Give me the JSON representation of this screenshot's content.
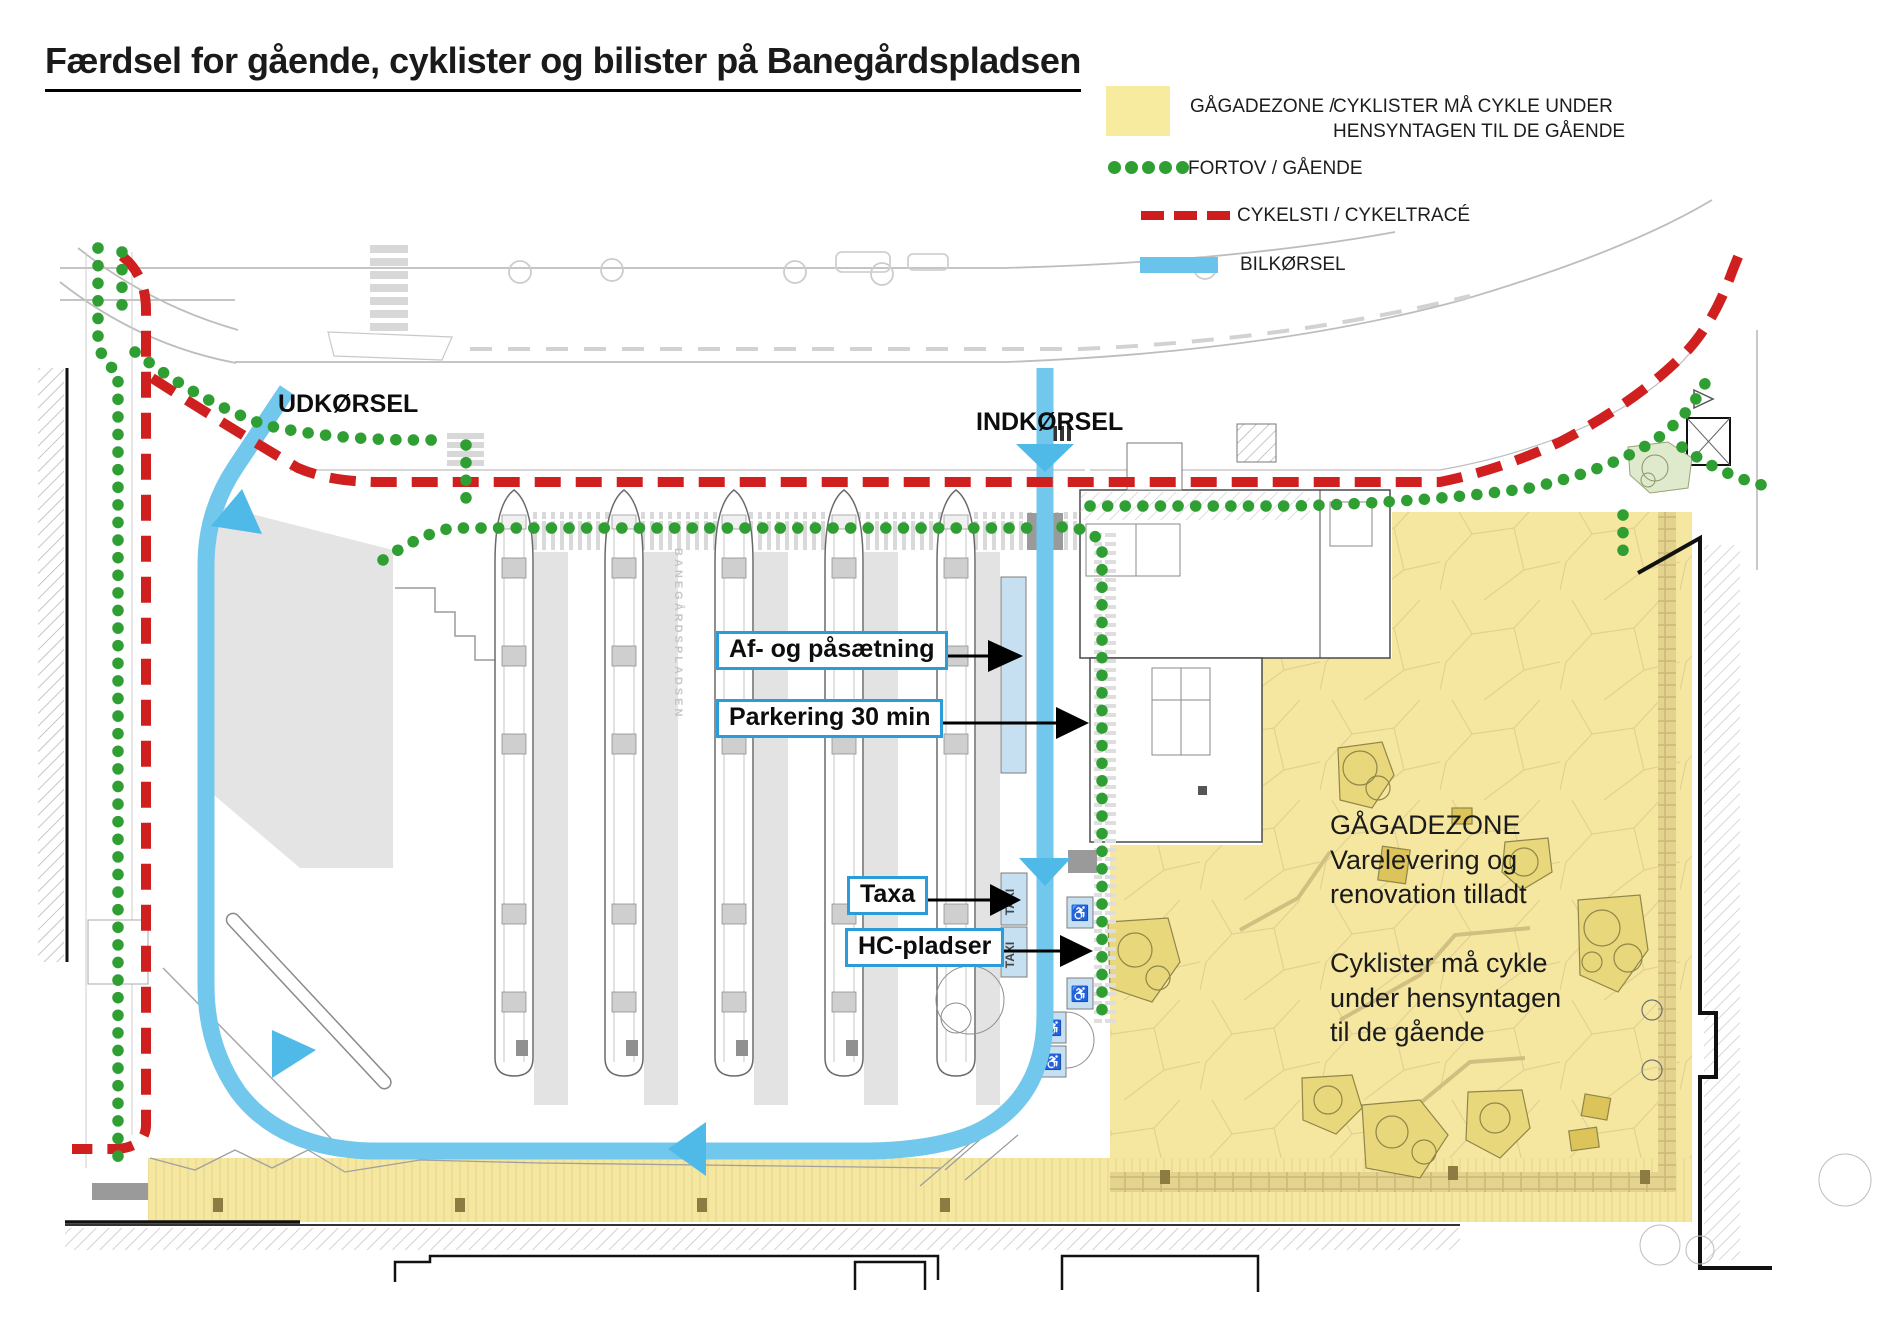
{
  "title": "Færdsel for gående, cyklister og bilister på Banegårdspladsen",
  "legend": {
    "items": [
      {
        "label": "GÅGADEZONE /",
        "label2": "CYKLISTER MÅ CYKLE UNDER\nHENSYNTAGEN TIL DE GÅENDE",
        "swatch": "yellow-zone"
      },
      {
        "label": "FORTOV / GÅENDE",
        "swatch": "green-dots"
      },
      {
        "label": "CYKELSTI / CYKELTRACÉ",
        "swatch": "red-dashes"
      },
      {
        "label": "BILKØRSEL",
        "swatch": "blue-bar"
      }
    ]
  },
  "map": {
    "labels": {
      "exit": "UDKØRSEL",
      "entrance": "INDKØRSEL"
    },
    "callouts": {
      "dropoff": "Af- og påsætning",
      "parking": "Parkering 30 min",
      "taxi": "Taxa",
      "hc": "HC-pladser"
    },
    "zone_text": "GÅGADEZONE\nVarelevering og\nrenovation tilladt\n\nCyklister må cykle\nunder hensyntagen\ntil de gående",
    "taxi_bay_label": "TAXI",
    "hc_symbol": "♿",
    "watermark": "BANEGÅRDSPLADSEN"
  },
  "colors": {
    "pedestrian_zone": "#f5e7a0",
    "sidewalk_dots": "#2f9e33",
    "cycle_dashes": "#d01f1f",
    "car_route": "#72c7ec",
    "parking_bay": "#c6e0f2",
    "callout_border": "#2b9cd8"
  }
}
